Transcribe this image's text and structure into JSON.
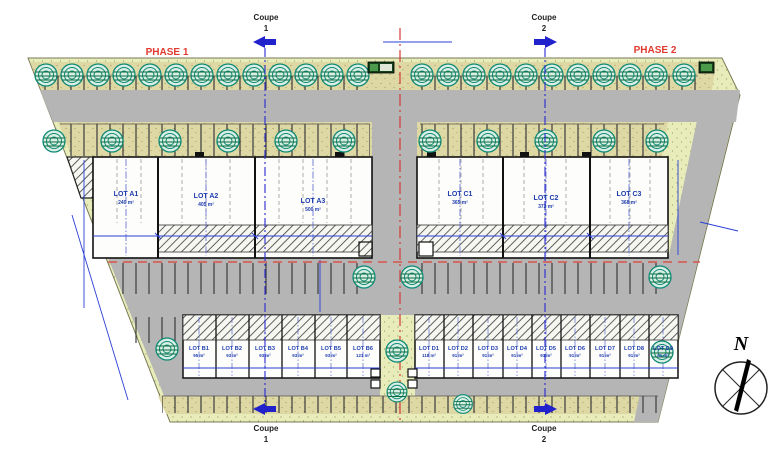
{
  "labels": {
    "phase1": "PHASE 1",
    "phase2": "PHASE 2",
    "north": "N"
  },
  "sections": {
    "coupe1": {
      "word": "Coupe",
      "num": "1"
    },
    "coupe2": {
      "word": "Coupe",
      "num": "2"
    }
  },
  "lots": {
    "a": [
      {
        "name": "LOT A1",
        "area": "240 m²"
      },
      {
        "name": "LOT A2",
        "area": "405 m²"
      },
      {
        "name": "LOT A3",
        "area": "500 m²"
      }
    ],
    "c": [
      {
        "name": "LOT C1",
        "area": "365 m²"
      },
      {
        "name": "LOT C2",
        "area": "372 m²"
      },
      {
        "name": "LOT C3",
        "area": "368 m²"
      }
    ],
    "b": [
      {
        "name": "LOT B1",
        "area": "95 m²"
      },
      {
        "name": "LOT B2",
        "area": "93 m²"
      },
      {
        "name": "LOT B3",
        "area": "93 m²"
      },
      {
        "name": "LOT B4",
        "area": "93 m²"
      },
      {
        "name": "LOT B5",
        "area": "93 m²"
      },
      {
        "name": "LOT B6",
        "area": "121 m²"
      }
    ],
    "d": [
      {
        "name": "LOT D1",
        "area": "118 m²"
      },
      {
        "name": "LOT D2",
        "area": "91 m²"
      },
      {
        "name": "LOT D3",
        "area": "91 m²"
      },
      {
        "name": "LOT D4",
        "area": "91 m²"
      },
      {
        "name": "LOT D5",
        "area": "91 m²"
      },
      {
        "name": "LOT D6",
        "area": "91 m²"
      },
      {
        "name": "LOT D7",
        "area": "91 m²"
      },
      {
        "name": "LOT D8",
        "area": "91 m²"
      },
      {
        "name": "LOT D9",
        "area": "91 m²"
      }
    ]
  },
  "colors": {
    "phase_label": "#e03a2f",
    "lot_label": "#1e3cae",
    "road": "#b5b5b5",
    "landscape": "#e7ecba",
    "parking_band": "#ded8a4",
    "tree": "#0e8a74",
    "section_line": "#2a2ad0",
    "phase_boundary_line": "#d23b35"
  }
}
